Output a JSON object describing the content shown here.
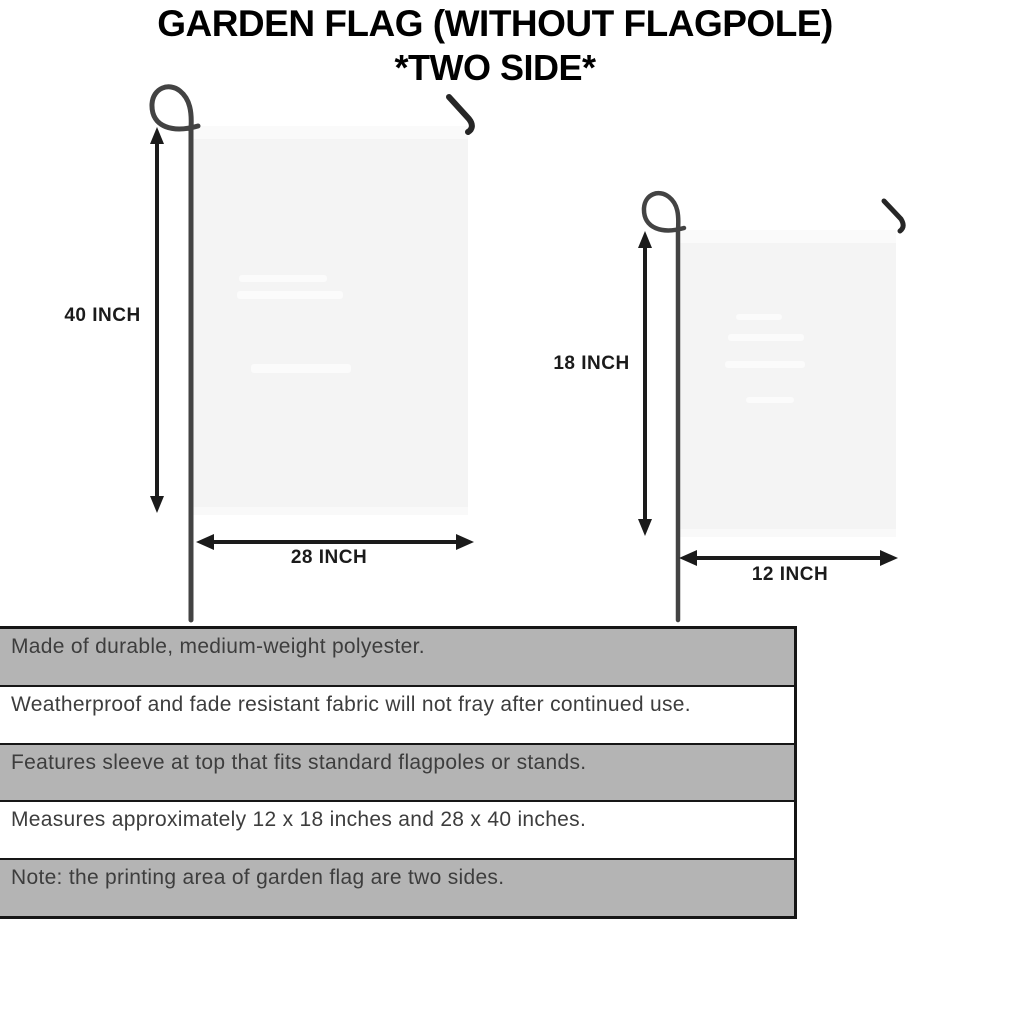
{
  "title": {
    "line1": "GARDEN FLAG (WITHOUT FLAGPOLE)",
    "line2": "*TWO SIDE*"
  },
  "diagram": {
    "large_flag": {
      "height_label": "40 INCH",
      "width_label": "28 INCH"
    },
    "small_flag": {
      "height_label": "18 INCH",
      "width_label": "12 INCH"
    }
  },
  "features": [
    {
      "text": "Made of durable, medium-weight polyester."
    },
    {
      "text": "Weatherproof and fade resistant fabric will not fray after continued use."
    },
    {
      "text": "Features sleeve at top that fits standard flagpoles or stands."
    },
    {
      "text": "Measures approximately 12 x 18 inches and 28 x 40 inches."
    },
    {
      "text": "Note: the printing area of garden flag are two sides."
    }
  ],
  "colors": {
    "shaded_row": "#b4b4b4",
    "row_border": "#161616",
    "flag_fill": "#f4f4f4",
    "pole": "#434343",
    "arrow": "#1b1b1b",
    "body_text": "#3d3d3d",
    "title_text": "#000000"
  }
}
